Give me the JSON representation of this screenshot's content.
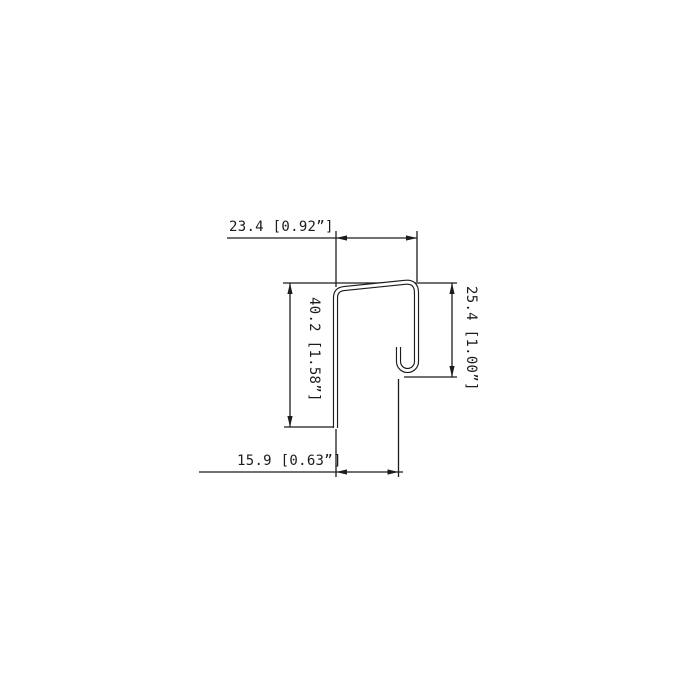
{
  "drawing": {
    "dimensions": {
      "top_width": {
        "label": "23.4 [0.92”]",
        "mm": "23.4",
        "inches": "0.92"
      },
      "bottom_width": {
        "label": "15.9 [0.63”]",
        "mm": "15.9",
        "inches": "0.63"
      },
      "left_height": {
        "label": "40.2 [1.58”]",
        "mm": "40.2",
        "inches": "1.58"
      },
      "right_height": {
        "label": "25.4 [1.00”]",
        "mm": "25.4",
        "inches": "1.00"
      }
    },
    "colors": {
      "line": "#1c1c1c",
      "background": "#ffffff"
    }
  }
}
